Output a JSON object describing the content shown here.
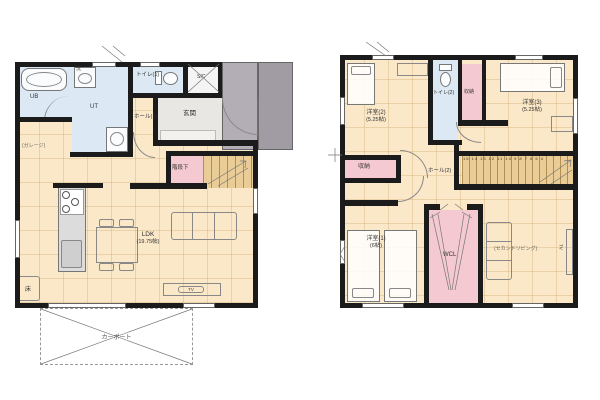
{
  "colors": {
    "wall": "#1b1b1b",
    "floor": "#fbe8c8",
    "wet": "#dce8f4",
    "pink": "#f5c9d1",
    "stairs_fill": "#eacd96",
    "porch_inner": "#b3aeb5",
    "porch_outer": "#a19ca3",
    "entry": "#e9e7e4"
  },
  "floor1": {
    "ub": "UB",
    "laundry": "洗",
    "utility": "UT",
    "toilet": "トイレ(1)",
    "sic": "SIC",
    "entrance": "玄関",
    "hall": "ホール(1)",
    "garage_note": "(ガレージ)",
    "under_stairs": "階段下",
    "ldk_name": "LDK",
    "ldk_size": "(19.75帖)",
    "floor_storage": "床",
    "tv": "TV",
    "carport": "カーポート"
  },
  "floor2": {
    "bedroom2_name": "洋室(2)",
    "bedroom2_size": "(5.25帖)",
    "toilet": "トイレ(2)",
    "closet_top": "収納",
    "bedroom3_name": "洋室(3)",
    "bedroom3_size": "(5.25帖)",
    "closet_left": "収納",
    "hall": "ホール(2)",
    "stair_numbers": "15 14 13 12 11 10 9 8 7 6 5 4",
    "bedroom1_name": "洋室(1)",
    "bedroom1_size": "(6帖)",
    "wcl": "WCL",
    "second_living": "(セカンドリビング)",
    "tv": "TV"
  }
}
